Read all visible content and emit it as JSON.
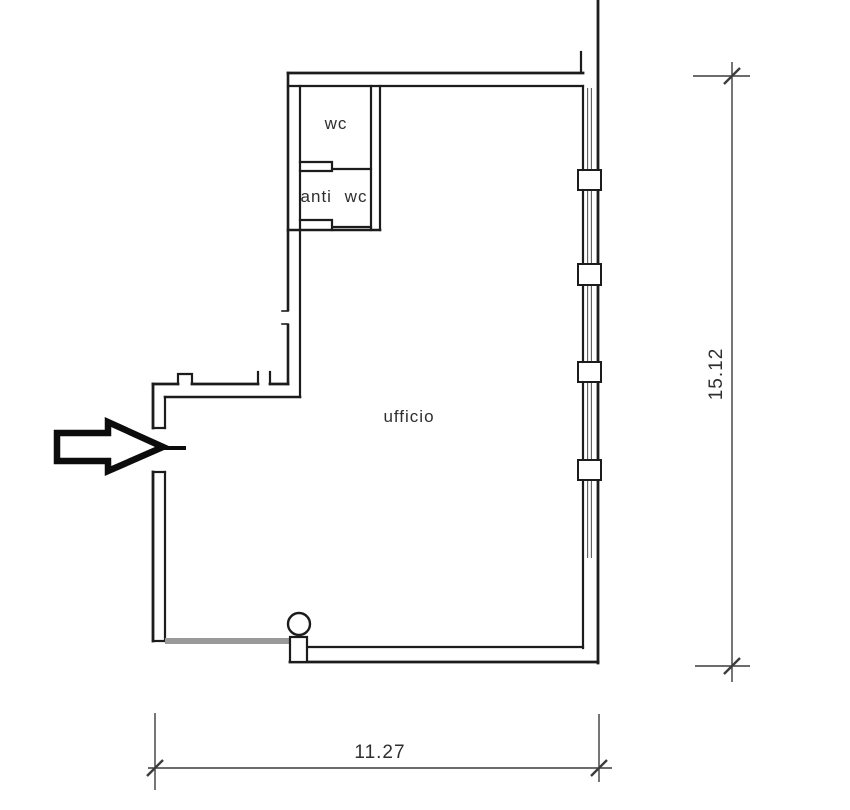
{
  "plan": {
    "type": "floor-plan",
    "rooms": [
      {
        "label": "wc"
      },
      {
        "label": "anti wc"
      },
      {
        "label": "ufficio"
      }
    ],
    "dimensions": [
      {
        "label": "15.12",
        "orientation": "vertical",
        "side": "right"
      },
      {
        "label": "11.27",
        "orientation": "horizontal",
        "side": "bottom"
      }
    ],
    "icons": [
      {
        "name": "entrance-arrow-icon",
        "meaning": "entrance direction pointing right into door opening"
      },
      {
        "name": "column-circle",
        "meaning": "round column at bottom wall"
      }
    ],
    "colors": {
      "wall_line": "#1c1c1c",
      "dimension_line": "#3c3c3c",
      "label_text": "#2e2e2e",
      "gray_partition": "#999999",
      "background": "#ffffff"
    }
  }
}
